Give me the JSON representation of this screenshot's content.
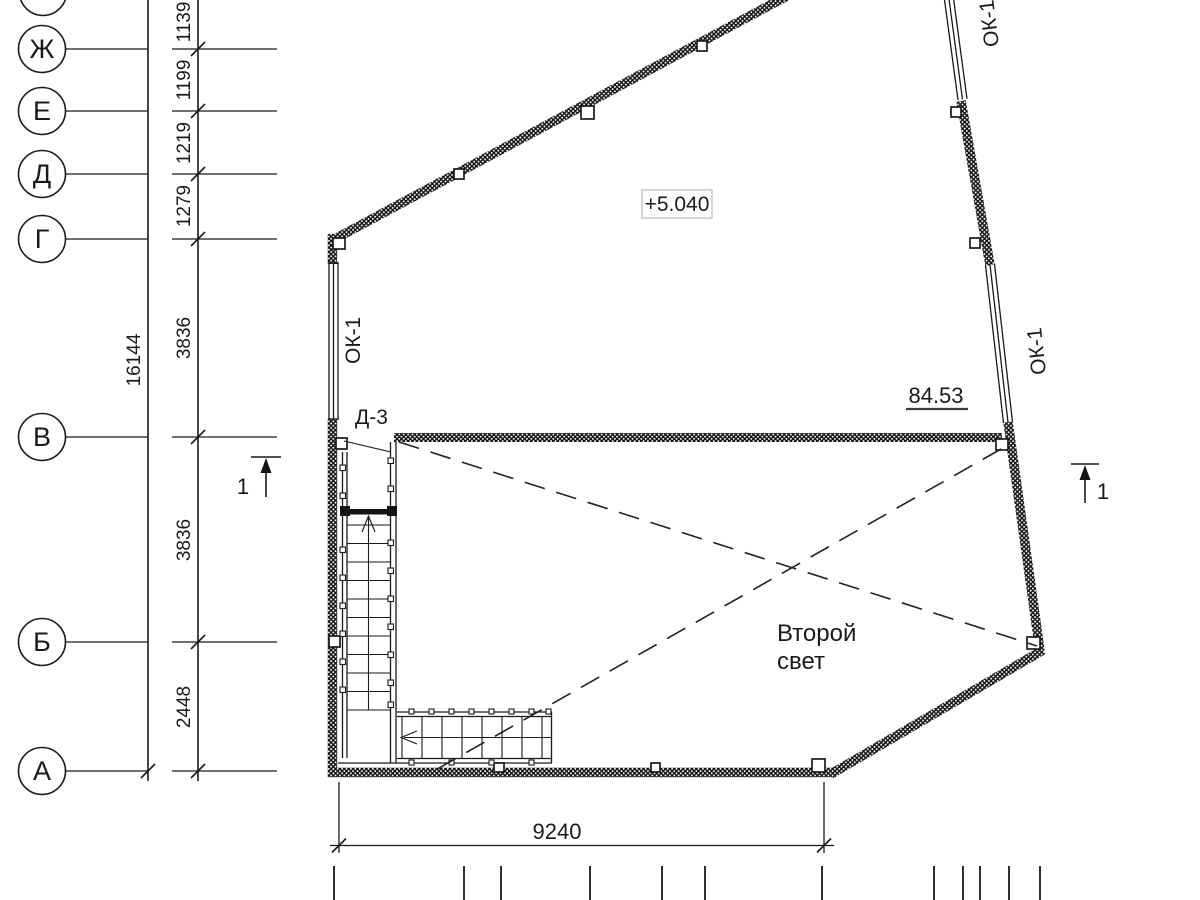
{
  "drawing": {
    "axis_rows": [
      {
        "label": "Ж"
      },
      {
        "label": "Е"
      },
      {
        "label": "Д"
      },
      {
        "label": "Г"
      },
      {
        "label": "В"
      },
      {
        "label": "Б"
      },
      {
        "label": "А"
      }
    ],
    "left_dims": {
      "d1": "1139",
      "d2": "1199",
      "d3": "1219",
      "d4": "1279",
      "d5": "3836",
      "d6": "3836",
      "d7": "2448",
      "total": "16144"
    },
    "bottom_dim": "9240",
    "level_mark": "+5.040",
    "elevation_mark": "84.53",
    "void_label_line1": "Второй",
    "void_label_line2": "свет",
    "door_mark": "Д-3",
    "window_mark": "ОК-1",
    "section_mark": "1",
    "colors": {
      "ink": "#1a1a1a",
      "level_box_border": "#c9c9c9",
      "paper": "#ffffff"
    }
  }
}
